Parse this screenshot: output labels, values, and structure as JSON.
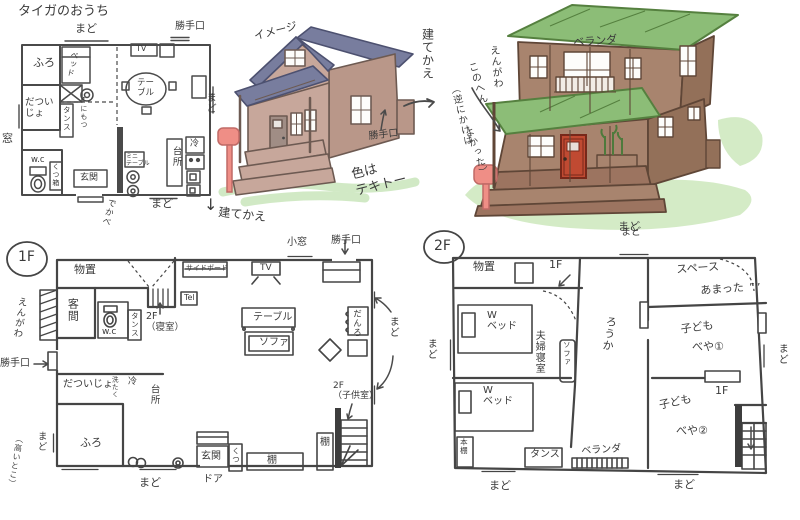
{
  "old_plan": {
    "title": "タイガのおうち",
    "mado_top": "まど",
    "katteguchi": "勝手口",
    "tv": "TV",
    "mado_right": "まど",
    "furo": "ふろ",
    "bed": "ベッド",
    "nimotsu": "↑にもつ",
    "tansu": "タンス",
    "datsuijo": "だつい\nじょ",
    "mado_left": "窓",
    "wc": "w.c",
    "genkan": "玄関",
    "kutsubako": "くつ箱",
    "dekabe": "でかべ",
    "minitable": "ミニ\nテーブル",
    "table": "テー\nブル",
    "daidokoro": "台所",
    "rei": "冷",
    "mado_bottom": "まど"
  },
  "sketch": {
    "label": "イメージ",
    "katteguchi": "勝手口",
    "color_note": "色は\nテキトー",
    "down_arrow": "↓",
    "rebuild": "建てかえ"
  },
  "rebuild_note": {
    "label": "建てかえ",
    "engawa1": "えんがわ",
    "engawa2": "このへん",
    "regret1": "（逆にかけば",
    "regret2": "よかった）"
  },
  "new_house": {
    "veranda": "ベランダ",
    "mado": "まど"
  },
  "plan1f": {
    "badge": "1F",
    "monooki": "物置",
    "engawa": "えんがわ",
    "kyakuma": "客間",
    "katteguchi_left": "勝手口",
    "wc": "w.c",
    "tansu": "タンス",
    "stairs_up": "2F\n（寝室）",
    "sideboard": "サイドボード",
    "komado": "小窓",
    "katteguchi_top": "勝手口",
    "tv": "TV",
    "tel": "Tel",
    "table": "テーブル",
    "sofa": "ソファ",
    "danro": "だんろ",
    "mado_right": "まど",
    "datsuijo": "だついじょ",
    "sentaku": "洗たく",
    "rei": "冷",
    "daidokoro": "台所",
    "furo": "ふろ",
    "mado_left": "まど",
    "takaitoko": "（高いとこ）",
    "mado_bottom": "まど",
    "genkan": "玄関",
    "kutsu": "くつ",
    "door": "ドア",
    "tana": "棚",
    "tana2": "棚",
    "stairs_down_note": "2F\n（子供室）"
  },
  "plan2f": {
    "badge": "2F",
    "monooki": "物置",
    "to1f": "1F",
    "mado_top": "まど",
    "wbed": "W\nベッド",
    "fuufu": "夫婦寝室",
    "sofa": "ソファ",
    "rouka": "ろうか",
    "space1": "スペース",
    "space2": "あまった",
    "sweat": "””",
    "kodomo1a": "子ども",
    "kodomo1b": "べや①",
    "mado_right": "まど",
    "to1f2": "1F",
    "kodomo2a": "子ども",
    "kodomo2b": "べや②",
    "wbed2": "W\nベッド",
    "hondana": "本棚",
    "tansu": "タンス",
    "veranda": "ベランダ",
    "mado_left": "まど",
    "mado_b1": "まど",
    "mado_b2": "まど"
  }
}
